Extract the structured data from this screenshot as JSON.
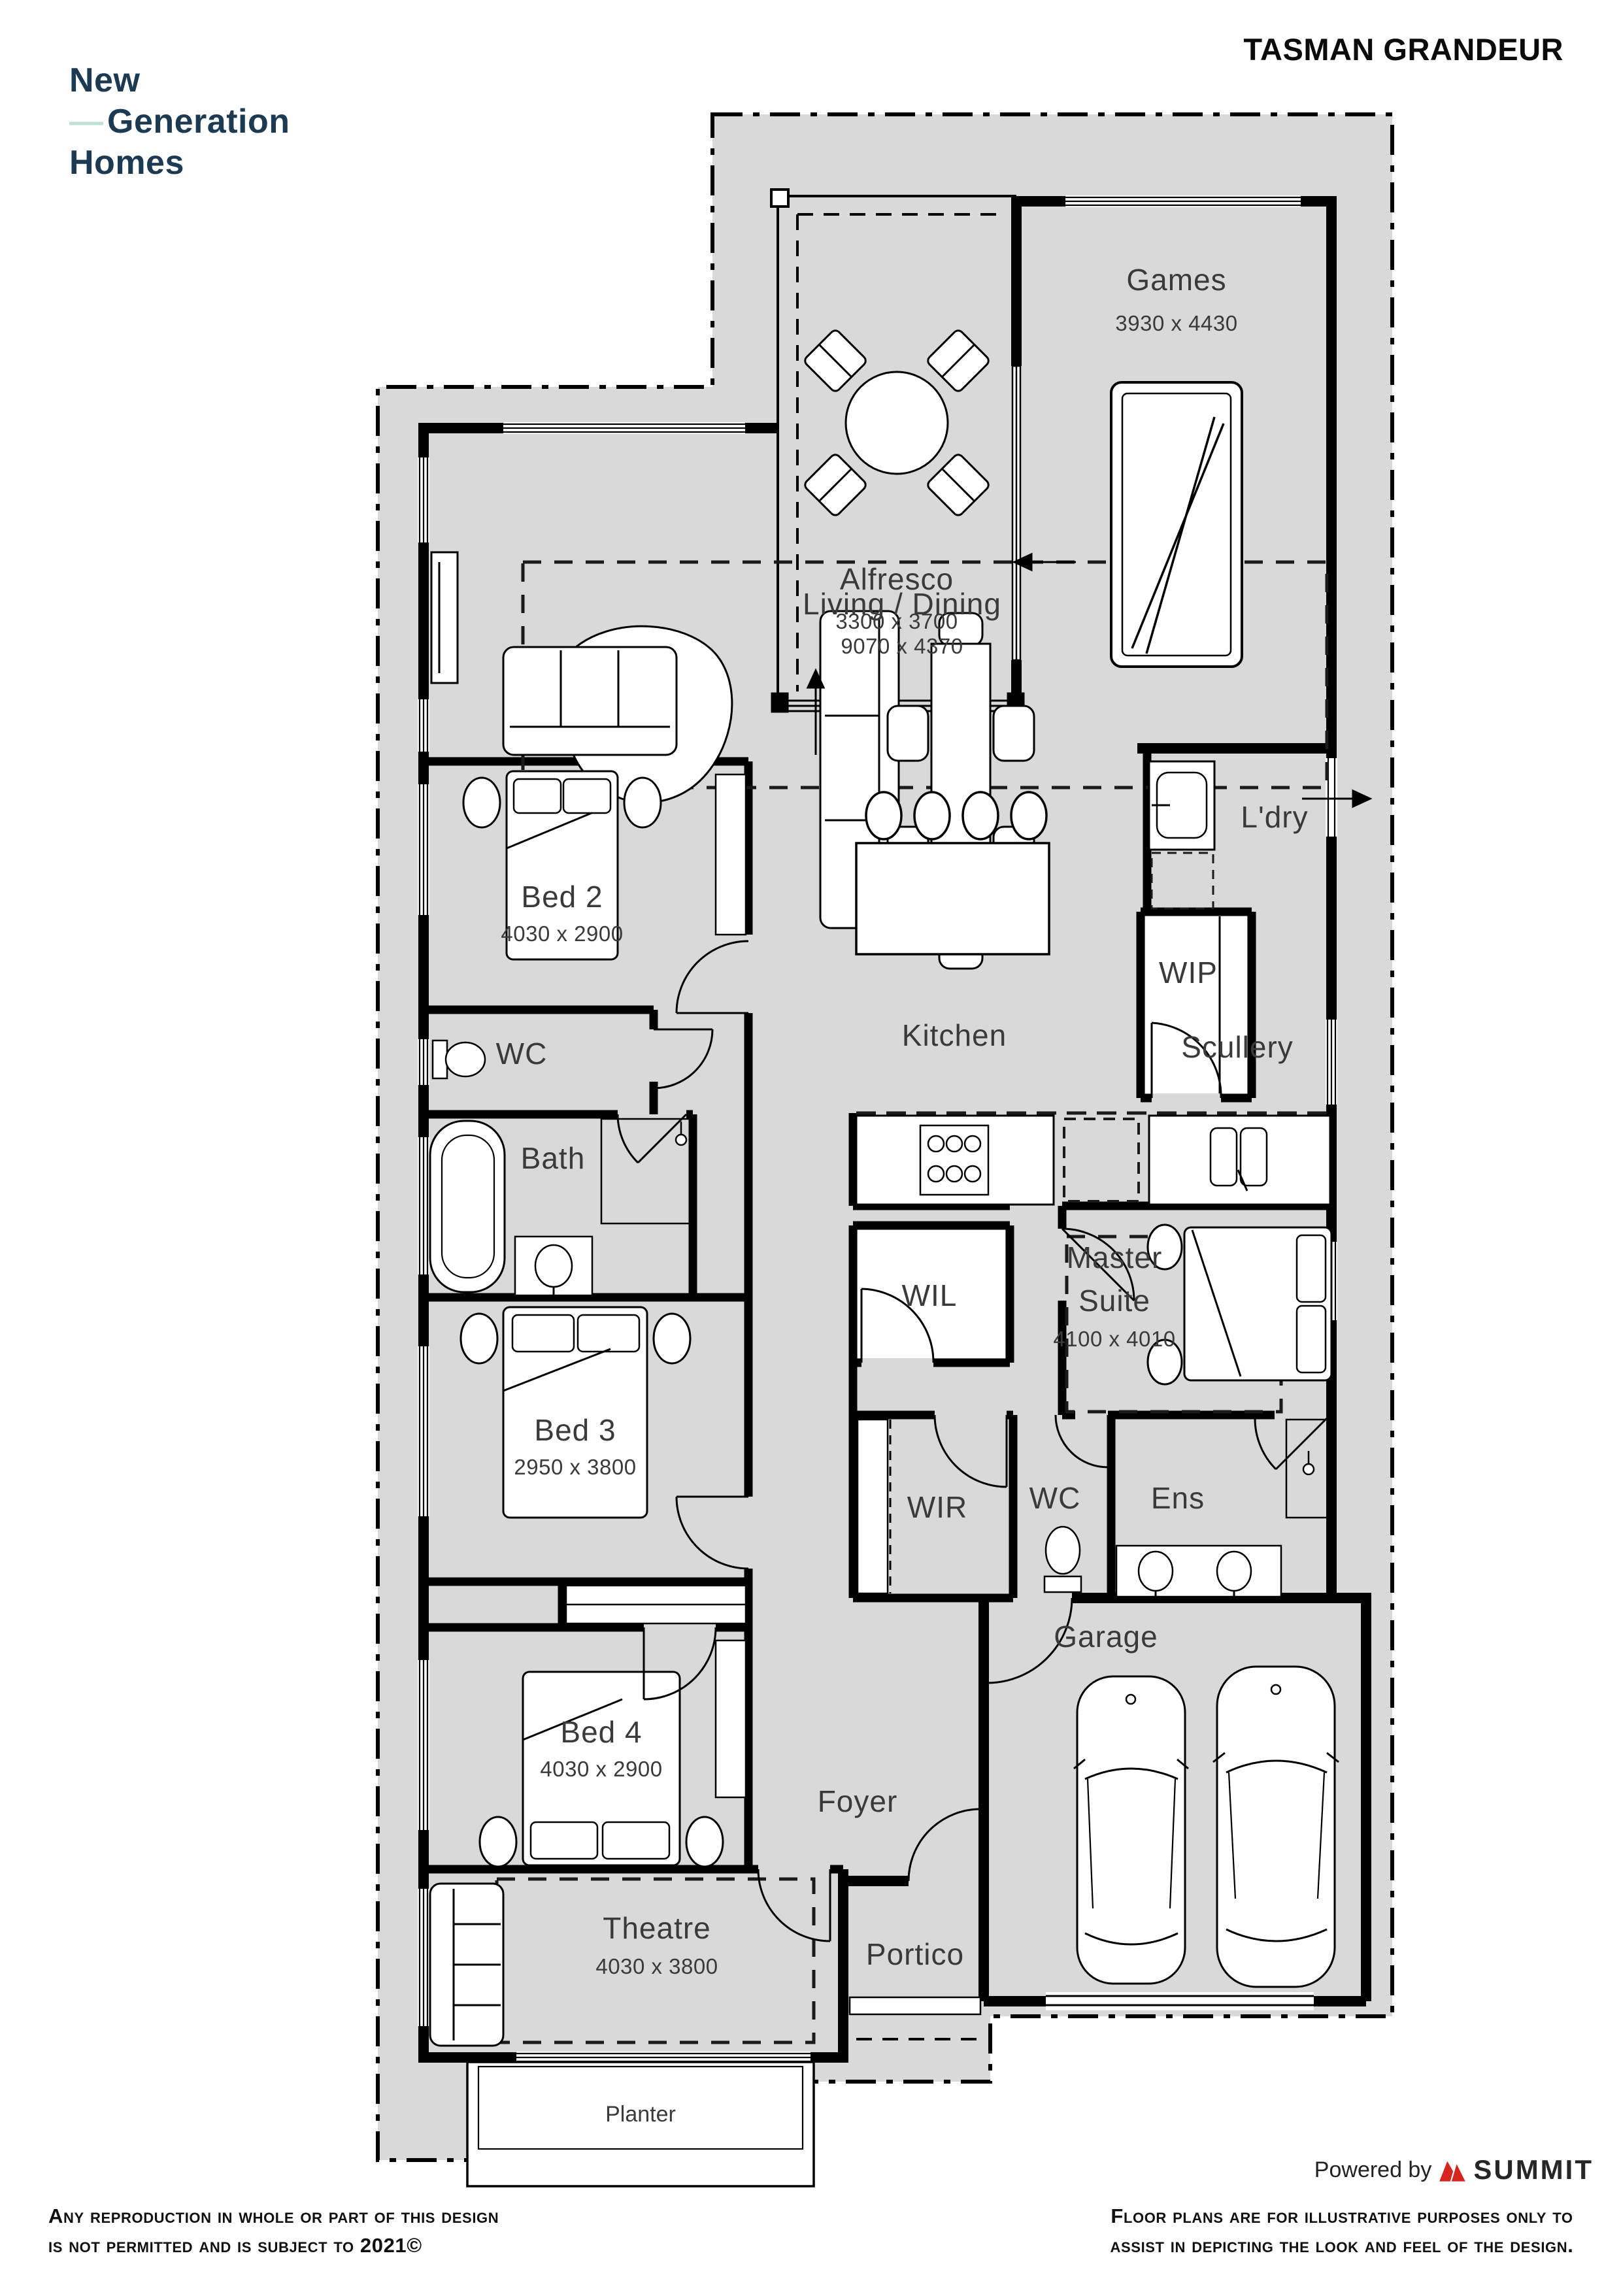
{
  "header": {
    "logo_line1": "New",
    "logo_dash": "—",
    "logo_line2": "Generation",
    "logo_line3": "Homes",
    "plan_title": "TASMAN GRANDEUR"
  },
  "rooms": [
    {
      "name": "Games",
      "dim": "3930 x 4430"
    },
    {
      "name": "Alfresco",
      "dim": "3300 x 3700"
    },
    {
      "name": "Living / Dining",
      "dim": "9070 x 4370"
    },
    {
      "name": "L'dry"
    },
    {
      "name": "WIP"
    },
    {
      "name": "Bed 2",
      "dim": "4030 x 2900"
    },
    {
      "name": "Kitchen"
    },
    {
      "name": "Scullery"
    },
    {
      "name": "WC"
    },
    {
      "name": "WIL"
    },
    {
      "name": "Bath"
    },
    {
      "name": "Master Suite",
      "line1": "Master",
      "line2": "Suite",
      "dim": "4100 x 4010"
    },
    {
      "name": "Bed 3",
      "dim": "2950 x 3800"
    },
    {
      "name": "WIR"
    },
    {
      "name": "WC"
    },
    {
      "name": "Ens"
    },
    {
      "name": "Garage"
    },
    {
      "name": "Bed 4",
      "dim": "4030 x 2900"
    },
    {
      "name": "Foyer"
    },
    {
      "name": "Theatre",
      "dim": "4030 x 3800"
    },
    {
      "name": "Portico"
    },
    {
      "name": "Planter"
    }
  ],
  "footer": {
    "left_line1": "Any reproduction in whole or part of this design",
    "left_line2": "is not permitted and is subject to 2021©",
    "right_line1": "Floor plans are for illustrative purposes only to",
    "right_line2": "assist in depicting the look and feel of the design.",
    "powered_by": "Powered by",
    "brand": "SUMMIT"
  },
  "colors": {
    "site_fill": "#d9d9d9",
    "wall": "#000000",
    "label": "#3a3a3a",
    "logo_navy": "#1c3a52",
    "logo_mint": "#bfe0d2",
    "brand_red": "#d6251f"
  }
}
